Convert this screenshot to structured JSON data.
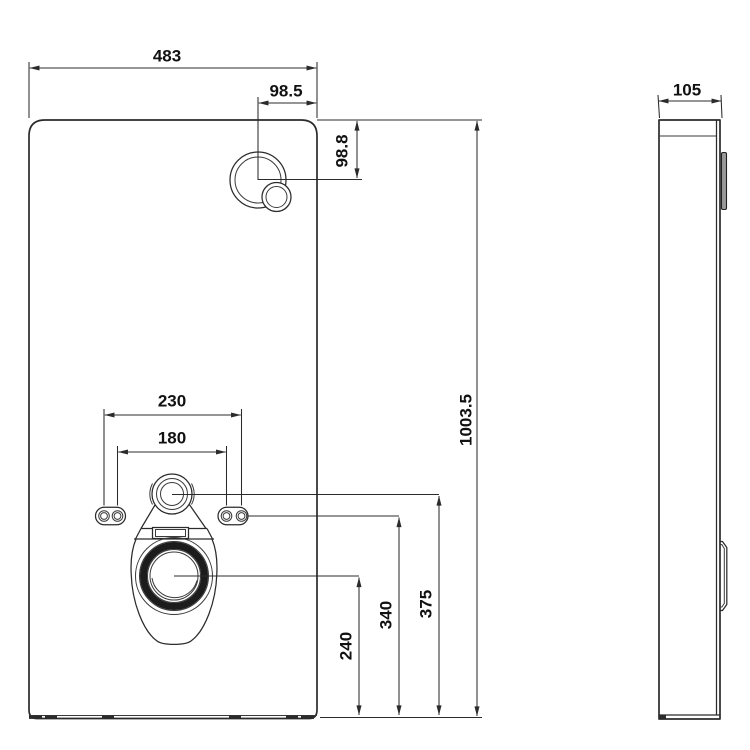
{
  "drawing": {
    "type": "technical-drawing",
    "subject": "sanitary-cistern-module",
    "colors": {
      "ink": "#2b2b2b",
      "label_text": "#111111",
      "background": "#ffffff",
      "seal_ring": "#1c1c1c",
      "flush_plate_side": "#9a9a9a"
    },
    "dims": {
      "width": "483",
      "button_offset_x": "98.5",
      "button_offset_y": "98.8",
      "bolt_spacing_outer": "230",
      "bolt_spacing_inner": "180",
      "outlet_height": "240",
      "bracket_height": "340",
      "inlet_height": "375",
      "height": "1003.5",
      "depth": "105"
    }
  }
}
